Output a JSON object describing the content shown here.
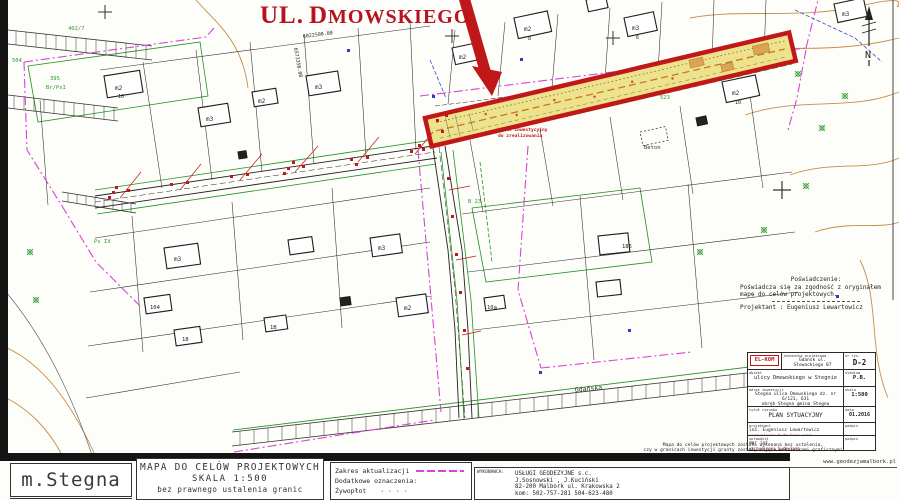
{
  "title": {
    "prefix": "UL.",
    "name": "DMOWSKIEGO"
  },
  "map": {
    "north": "N",
    "coord_y": "6022500.00",
    "coord_x": "6573350.00",
    "callout_line1": "obiekt inwestycyjny",
    "callout_line2": "do zrealizowania",
    "street_gdanska": "Gdańska",
    "beton": "Beton",
    "labels": {
      "b1": "m2",
      "b1n": "10",
      "b2": "m3",
      "b3": "m2",
      "b4": "m3",
      "b5": "m2",
      "b6": "m2",
      "b6n": "8",
      "b7": "m3",
      "b7n": "6",
      "b8": "m2",
      "b8n": "10",
      "b9": "m3",
      "b11": "m3",
      "b13": "m3",
      "b14": "185",
      "b15": "m2",
      "b16": "104",
      "b17": "18",
      "b18": "1B",
      "b20": "10a",
      "g1": "504",
      "g2": "395",
      "g3": "Br/PsI",
      "g4": "402/7",
      "g5": "B 23",
      "g6": "523",
      "g7": "Ps IV"
    }
  },
  "certification": {
    "heading": "Poświadczenie:",
    "line1": "Poświadcza się za zgodność z oryginałem",
    "line2": "mapę do celów projektowych.",
    "designer": "Projektant : Eugeniusz Lewartowicz"
  },
  "titleblock": {
    "logo": "EL-KOM",
    "unit_label": "jednostka projektowa",
    "unit": "Gdańsk ul. Słowackiego 87",
    "object_label": "obiekt",
    "object": "ulicy Dmowskiego w Stegnie",
    "location_label": "adres inwestycji",
    "location1": "Stegna ulica Dmowskiego dz. nr 6/121, 631",
    "location2": "obręb Stegna gmina Stegna",
    "drawing_label": "tytuł rysunku",
    "drawing": "PLAN SYTUACYJNY",
    "no_label": "nr rys.",
    "no": "D-2",
    "stage_label": "stadium",
    "stage": "P.B.",
    "scale_label": "skala",
    "scale": "1:500",
    "date_label": "data",
    "date": "01.2016",
    "designer_label": "projektant",
    "designer_name": "inż. Eugeniusz Lewartowicz",
    "designer_cert": "uprawnienia budowlane proj.",
    "checker_label": "sprawdził",
    "checker_name": "mgr inż.",
    "checker_cert": "uprawnienia budowlane",
    "sign_label": "podpis"
  },
  "disclaimer": {
    "line1": "Mapa do celów projektowych została wykonana bez ustalenia,",
    "line2": "czy w granicach inwestycji grunty zostały objęte wskaźnikami graficznymi"
  },
  "footer": {
    "town": "m.Stegna",
    "map_title": "MAPA DO CELÓW PROJEKTOWYCH",
    "map_scale": "SKALA 1:500",
    "map_note": "bez prawnego ustalenia granic",
    "legend_scope": "Zakres aktualizacji",
    "legend_additional": "Dodatkowe oznaczenia:",
    "legend_hedge": "Żywopłot",
    "legend_hedge_symbol": "·    ·    ·    ·",
    "contractor_label": "WYKONAWCA:",
    "contractor_name": "USŁUGI GEODEZYJNE s.c.",
    "contractor_people": "J.Sosnowski , J.Kuciński",
    "contractor_address": "82-200 Malbork    ul. Krakowska 2",
    "contractor_phones": "kom:  502-757-281      504-623-480",
    "website": "www.geodezjamalbork.pl"
  }
}
